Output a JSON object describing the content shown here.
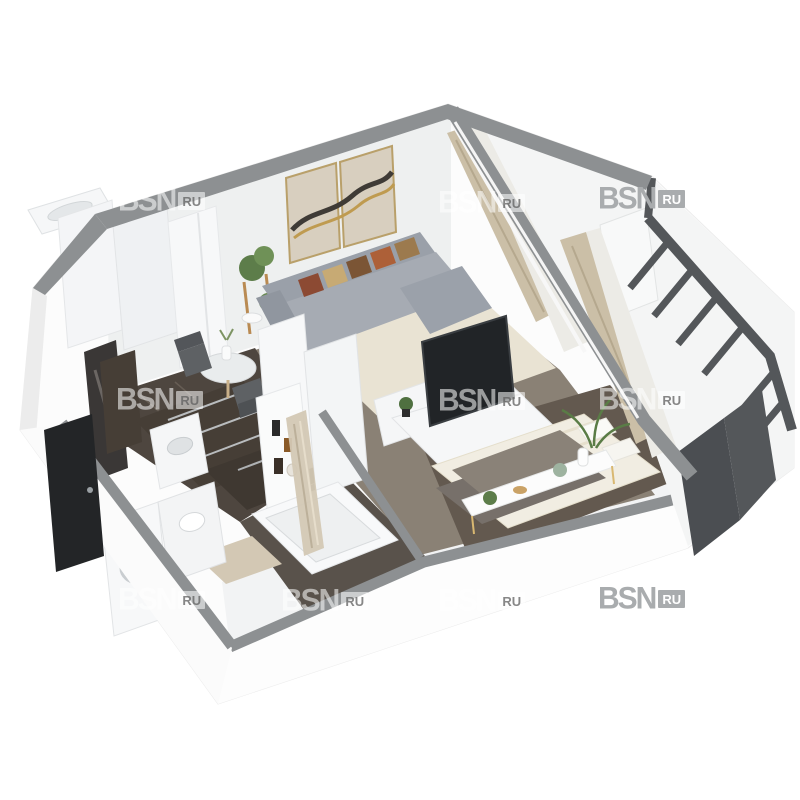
{
  "image": {
    "kind": "3d-apartment-floor-plan-render",
    "background": "#ffffff",
    "rooms_depicted": [
      "hallway",
      "kitchen",
      "living-room",
      "bedroom",
      "bathroom",
      "glazed-balcony"
    ],
    "objects_depicted": [
      "wardrobe",
      "ceiling-vent",
      "wall-art",
      "corner-sofa",
      "patterned-pillows",
      "rug",
      "plant-stand",
      "dining-table",
      "chairs",
      "kitchen-cabinets",
      "sink-counter",
      "tv",
      "tv-stand",
      "partition-shelf",
      "bed",
      "overbed-console",
      "palm-plant",
      "curtains",
      "washing-machine",
      "bathtub",
      "toilet",
      "bath-mat",
      "shower-curtain",
      "entrance-door",
      "mirror-panel",
      "balcony-glazing"
    ]
  },
  "watermark": {
    "brand": "BSN",
    "suffix": "RU",
    "solid_color": "#a9acae",
    "glass_opacity": 0.55,
    "instances": [
      {
        "x": 118,
        "y": 186,
        "style": "glass"
      },
      {
        "x": 438,
        "y": 188,
        "style": "glass"
      },
      {
        "x": 598,
        "y": 184,
        "style": "solid"
      },
      {
        "x": 116,
        "y": 385,
        "style": "glass"
      },
      {
        "x": 438,
        "y": 386,
        "style": "glass"
      },
      {
        "x": 598,
        "y": 385,
        "style": "glass"
      },
      {
        "x": 118,
        "y": 585,
        "style": "glass"
      },
      {
        "x": 281,
        "y": 586,
        "style": "glass"
      },
      {
        "x": 438,
        "y": 586,
        "style": "glass"
      },
      {
        "x": 598,
        "y": 584,
        "style": "solid"
      }
    ]
  },
  "palette": {
    "wall_top_band": "#8d9092",
    "wall_face": "#eef0f0",
    "floor_dark_wood": "#4e463f",
    "floor_living": "#8a8175",
    "floor_bedroom": "#63594f",
    "rug": "#e9e3d3",
    "sofa": "#9aa0a9",
    "sofa_seat": "#a6abb3",
    "pillow_red": "#8c4a33",
    "pillow_tan": "#c7aa74",
    "pillow_brown": "#7b5535",
    "art_canvas": "#d8cfbf",
    "art_gold": "#bf9b50",
    "art_dark": "#3f3b36",
    "curtain": "#cbbfa7",
    "sheer": "#ecebe6",
    "kitchen_cabinet": "#463e36",
    "balcony_frame": "#54575a",
    "balcony_panel": "#4b4e52",
    "tv": "#212427",
    "door": "#232527",
    "blanket": "#77706a",
    "bath_mat": "#d3c8b4",
    "white_furniture": "#f6f7f8"
  }
}
